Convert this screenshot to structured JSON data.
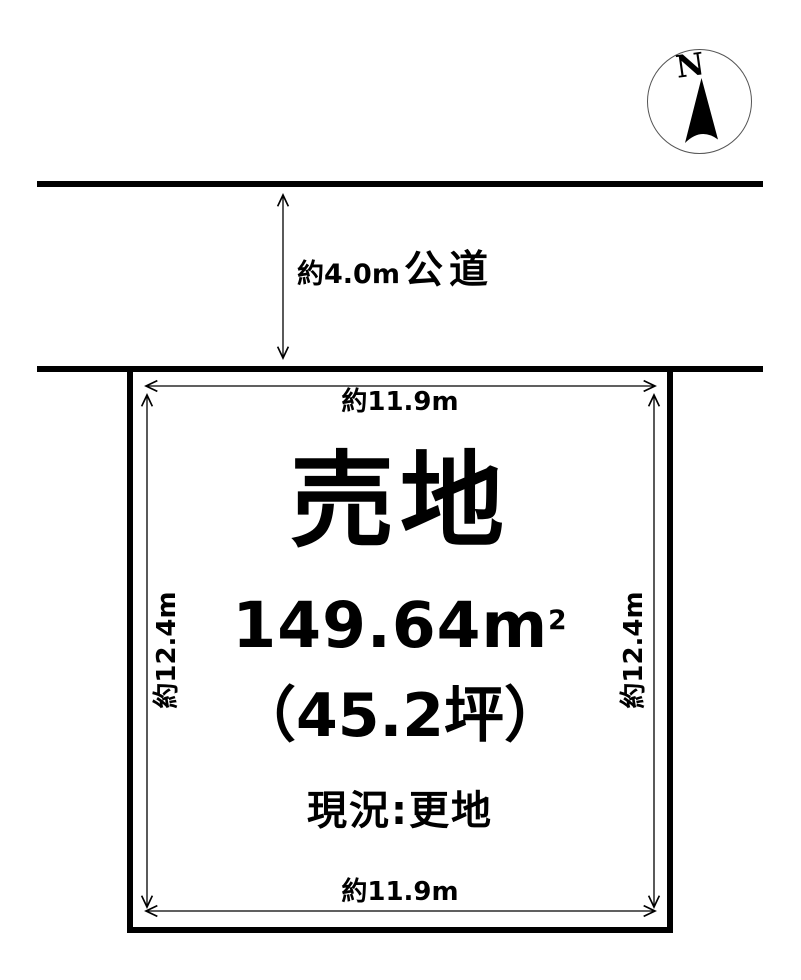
{
  "colors": {
    "background": "#ffffff",
    "ink": "#000000"
  },
  "compass": {
    "label": "N"
  },
  "road": {
    "width_label": "約4.0m",
    "name_label": "公道"
  },
  "plot": {
    "title": "売地",
    "area_value": "149.64m",
    "area_exponent": "2",
    "area_tsubo": "（45.2坪）",
    "status": "現況:更地",
    "dim_top": "約11.9m",
    "dim_bottom": "約11.9m",
    "dim_left": "約12.4m",
    "dim_right": "約12.4m"
  }
}
